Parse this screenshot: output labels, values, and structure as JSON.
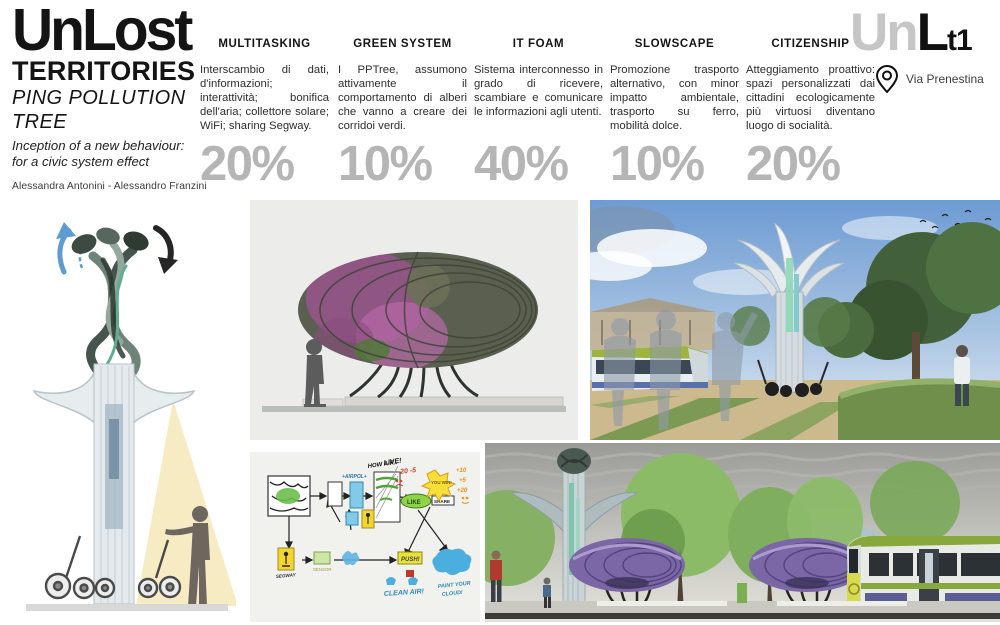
{
  "header": {
    "title": "UnLost",
    "subtitle": "TERRITORIES",
    "project_line1": "PING POLLUTION",
    "project_line2": "TREE",
    "tagline_line1": "Inception of a new behaviour:",
    "tagline_line2": "for a civic system effect",
    "authors": "Alessandra Antonini - Alessandro Franzini",
    "logo": {
      "part_gray": "Un",
      "part_black": "L",
      "part_sub": "t1",
      "location": "Via Prenestina"
    }
  },
  "columns": [
    {
      "label": "MULTITASKING",
      "text": "Interscambio di dati, d'informazioni; interattività; bonifica dell'aria; collettore solare; WiFi; sharing Segway.",
      "percent": "20%"
    },
    {
      "label": "GREEN SYSTEM",
      "text": "I PPTree, assumono attivamente il comportamento di alberi che vanno a creare dei corridoi verdi.",
      "percent": "10%"
    },
    {
      "label": "IT FOAM",
      "text": "Sistema interconnesso in grado di ricevere, scambiare e comunicare le informazioni agli utenti.",
      "percent": "40%"
    },
    {
      "label": "SLOWSCAPE",
      "text": "Promozione trasporto alternativo, con minor impatto ambientale, trasporto su ferro, mobilità dolce.",
      "percent": "10%"
    },
    {
      "label": "CITIZENSHIP",
      "text": "Atteggiamento proattivo: spazi personalizzati dai cittadini ecologicamente più virtuosi diventano luogo di socialità.",
      "percent": "20%"
    }
  ],
  "sketch_labels": {
    "how_air_1": "HOW AIR..",
    "how_air_2": "LIVE!",
    "airpol": "+AIRPOL+",
    "like": "LIKE",
    "share": "SHARE",
    "you_win": "YOU WIN!",
    "minus_scores": "-20 -5",
    "plus_1": "+10",
    "plus_2": "+5",
    "plus_3": "+20",
    "push": "PUSH!",
    "clean_air": "CLEAN AIR!",
    "paint_cloud_1": "PAINT YOUR",
    "paint_cloud_2": "CLOUD!",
    "segway": "SEGWAY",
    "sensor": "SENSOR"
  },
  "colors": {
    "percent_gray": "#b5b5b5",
    "logo_gray": "#c6c6c6",
    "pod_olive": "#5a5f50",
    "pod_pink": "#9c5290",
    "pod_purple": "#7b67a6",
    "cone_yellow": "#f6ebc3",
    "tram_green": "#88a83e"
  }
}
